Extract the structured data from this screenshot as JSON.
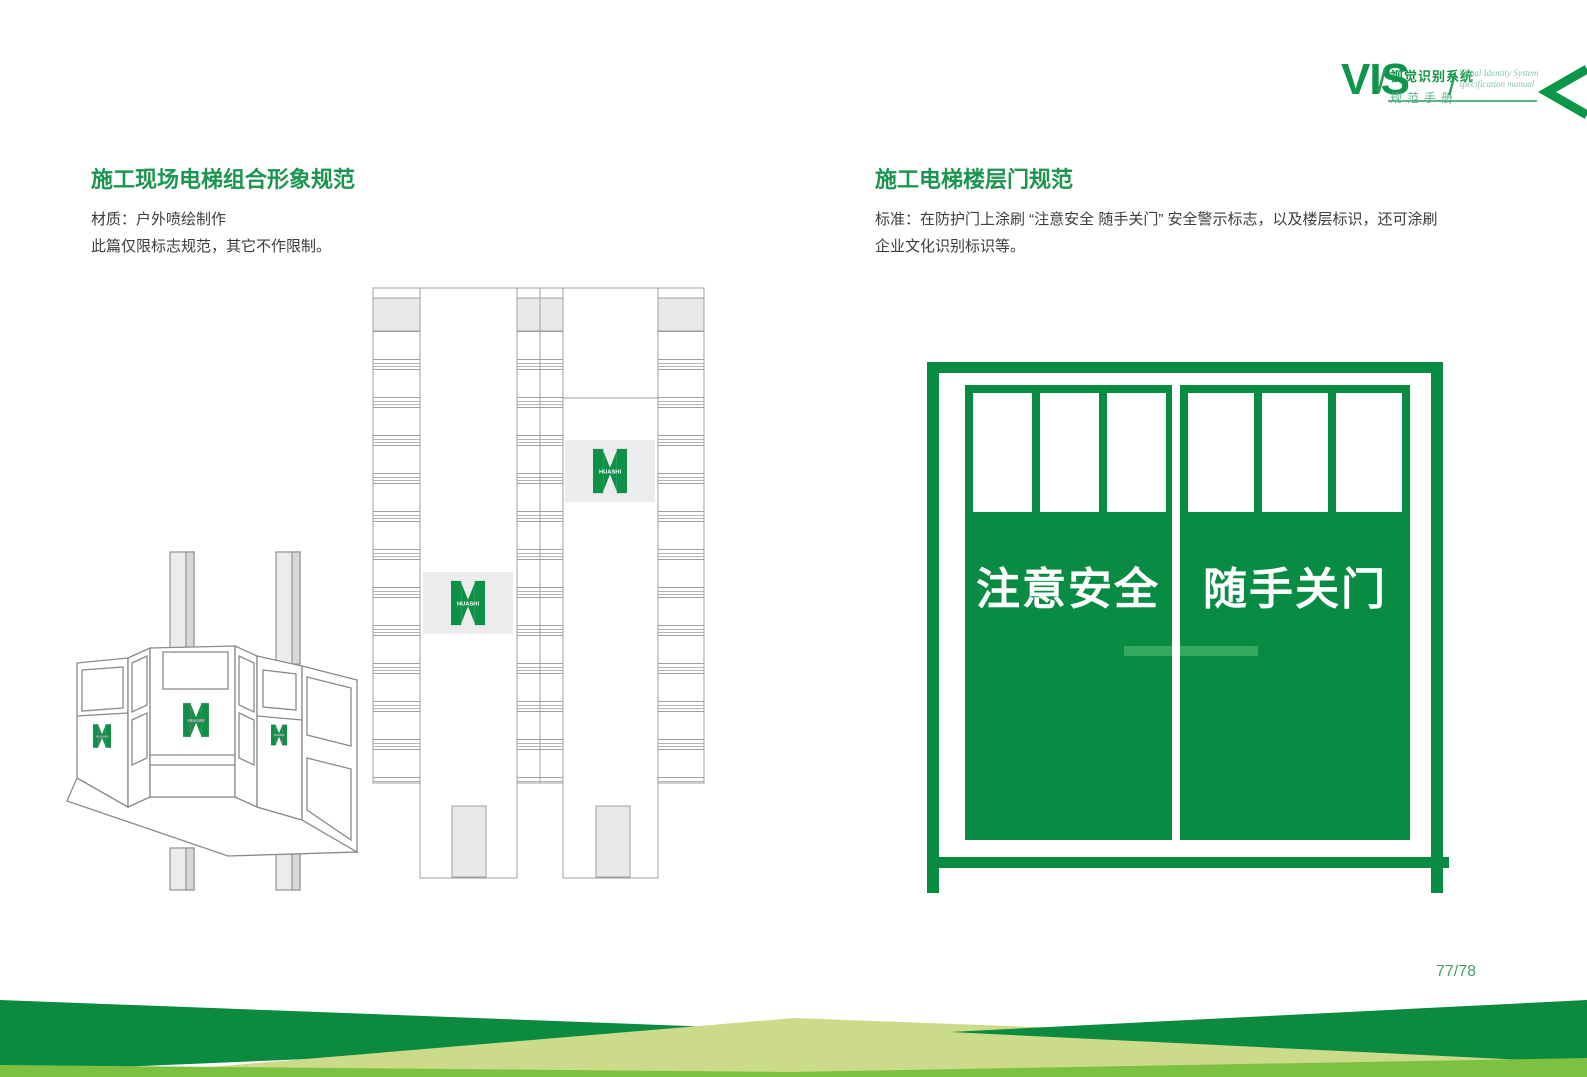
{
  "header": {
    "vis": "VIS",
    "slash1": "/",
    "slash2": "/",
    "cn_title": "视觉识别系统",
    "cn_subtitle": "规范手册",
    "en_title": "Visual Identity System",
    "en_subtitle": "specification manual"
  },
  "sections": {
    "left": {
      "title": "施工现场电梯组合形象规范",
      "line1": "材质：户外喷绘制作",
      "line2": "此篇仅限标志规范，其它不作限制。"
    },
    "right": {
      "title": "施工电梯楼层门规范",
      "line1": "标准：在防护门上涂刷 “注意安全 随手关门” 安全警示标志，以及楼层标识，还可涂刷",
      "line2": "企业文化识别标识等。"
    }
  },
  "door": {
    "left_text": "注意安全",
    "right_text": "随手关门"
  },
  "brand": "HUASHI",
  "page_number": "77/78",
  "colors": {
    "primary_green": "#088c44",
    "handle_green": "#35aa5f",
    "dark_green": "#0b8a40",
    "medium_green": "#7cc142",
    "olive_green": "#ccdb8a",
    "title_green": "#1d9551",
    "page_number_green": "#45a06d",
    "outline_gray": "#9f9f9f"
  }
}
